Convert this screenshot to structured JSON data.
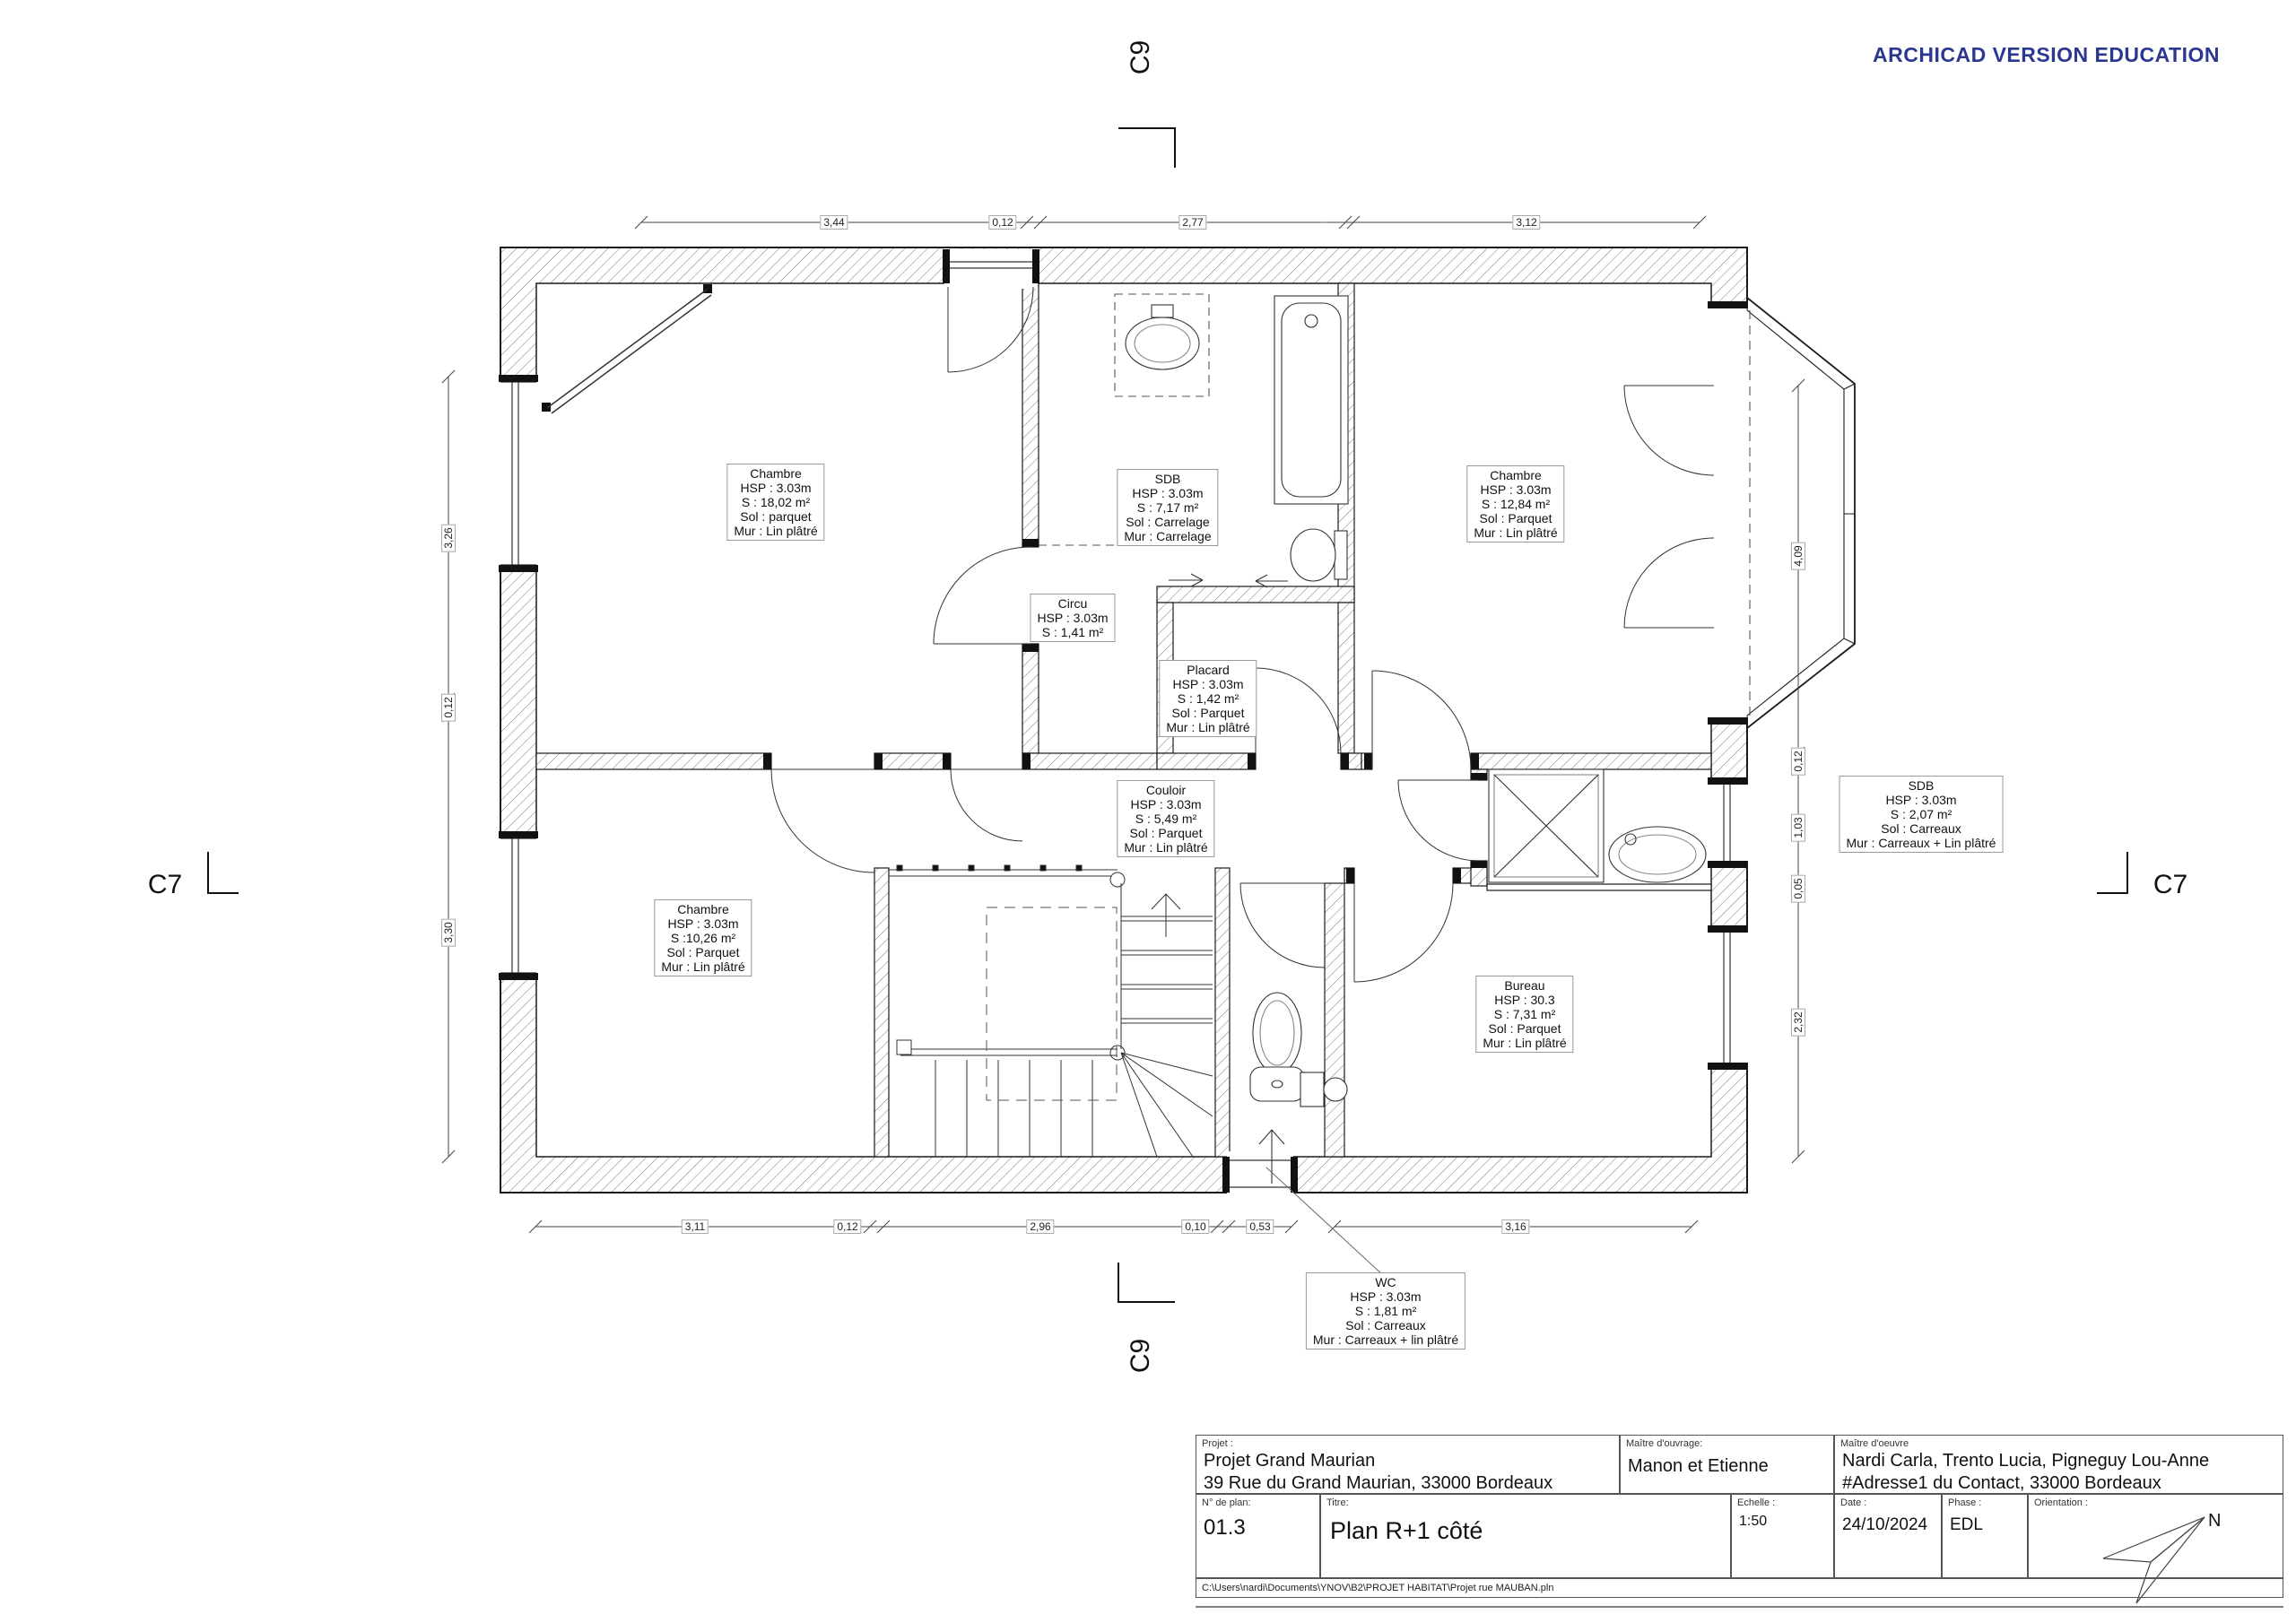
{
  "watermark": "ARCHICAD VERSION EDUCATION",
  "section_markers": {
    "top": "C9",
    "bottom": "C9",
    "left": "C7",
    "right": "C7"
  },
  "dimensions": {
    "top": [
      "3,44",
      "0,12",
      "2,77",
      "0,07",
      "3,12"
    ],
    "bottom": [
      "3,11",
      "0,12",
      "2,96",
      "0,10",
      "0,53",
      "3,16"
    ],
    "left": [
      "3,26",
      "0,12",
      "3,30"
    ],
    "right": [
      "4,09",
      "0,12",
      "1,03",
      "0,05",
      "2,32"
    ]
  },
  "rooms": [
    {
      "name": "chambre-nord-ouest",
      "lines": [
        "Chambre",
        "HSP : 3.03m",
        "S : 18,02 m²",
        "Sol : parquet",
        "Mur : Lin plâtré"
      ]
    },
    {
      "name": "sdb-nord",
      "lines": [
        "SDB",
        "HSP : 3.03m",
        "S : 7,17 m²",
        "Sol : Carrelage",
        "Mur : Carrelage"
      ]
    },
    {
      "name": "chambre-nord-est",
      "lines": [
        "Chambre",
        "HSP : 3.03m",
        "S : 12,84 m²",
        "Sol : Parquet",
        "Mur : Lin plâtré"
      ]
    },
    {
      "name": "circu",
      "lines": [
        "Circu",
        "HSP : 3.03m",
        "S : 1,41 m²"
      ]
    },
    {
      "name": "placard",
      "lines": [
        "Placard",
        "HSP : 3.03m",
        "S : 1,42 m²",
        "Sol : Parquet",
        "Mur : Lin plâtré"
      ]
    },
    {
      "name": "couloir",
      "lines": [
        "Couloir",
        "HSP : 3.03m",
        "S : 5,49 m²",
        "Sol : Parquet",
        "Mur : Lin plâtré"
      ]
    },
    {
      "name": "chambre-sud-ouest",
      "lines": [
        "Chambre",
        "HSP : 3.03m",
        "S :10,26 m²",
        "Sol : Parquet",
        "Mur : Lin plâtré"
      ]
    },
    {
      "name": "sdb-est",
      "lines": [
        "SDB",
        "HSP : 3.03m",
        "S : 2,07 m²",
        "Sol : Carreaux",
        "Mur : Carreaux + Lin plâtré"
      ]
    },
    {
      "name": "bureau",
      "lines": [
        "Bureau",
        "HSP : 30.3",
        "S : 7,31 m²",
        "Sol : Parquet",
        "Mur : Lin plâtré"
      ]
    },
    {
      "name": "wc",
      "lines": [
        "WC",
        "HSP : 3.03m",
        "S : 1,81 m²",
        "Sol : Carreaux",
        "Mur : Carreaux + lin plâtré"
      ]
    }
  ],
  "title_block": {
    "project_label": "Projet :",
    "project_name": "Projet Grand Maurian",
    "project_address": "39 Rue du Grand Maurian, 33000 Bordeaux",
    "owner_label": "Maître d'ouvrage:",
    "owner": "Manon et Etienne",
    "architect_label": "Maître d'oeuvre",
    "architect": "Nardi Carla, Trento Lucia, Pigneguy Lou-Anne",
    "architect_address": "#Adresse1 du Contact, 33000 Bordeaux",
    "plan_number_label": "N° de plan:",
    "plan_number": "01.3",
    "title_label": "Titre:",
    "title": "Plan R+1 côté",
    "scale_label": "Echelle :",
    "scale": "1:50",
    "date_label": "Date :",
    "date": "24/10/2024",
    "phase_label": "Phase :",
    "phase": "EDL",
    "orientation_label": "Orientation :",
    "north": "N",
    "file_path": "C:\\Users\\nardi\\Documents\\YNOV\\B2\\PROJET HABITAT\\Projet rue MAUBAN.pln"
  }
}
